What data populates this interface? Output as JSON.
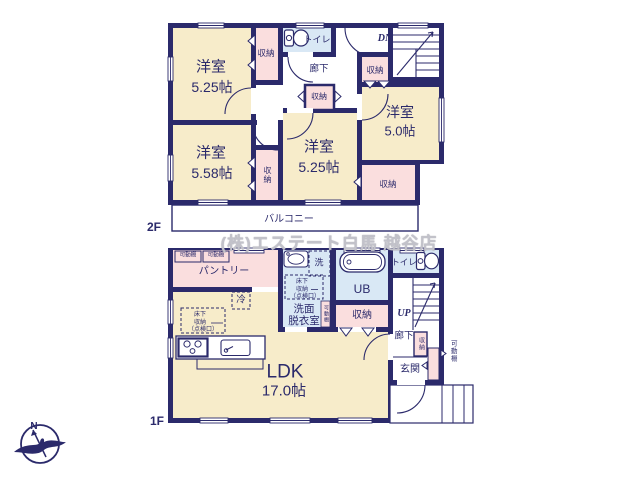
{
  "colors": {
    "wall": "#2b2a6b",
    "room_cream": "#f7ecca",
    "closet_pink": "#fadede",
    "wet_blue": "#d9e8f5",
    "watermark_gray": "#c2c2ca"
  },
  "watermark": "(株)エステート白馬 越谷店",
  "compass": {
    "north_label": "N"
  },
  "floor2": {
    "floor_label": "2F",
    "rooms": {
      "yoshitsu_a": {
        "name": "洋室",
        "size": "5.25帖"
      },
      "yoshitsu_b": {
        "name": "洋室",
        "size": "5.58帖"
      },
      "yoshitsu_c": {
        "name": "洋室",
        "size": "5.25帖"
      },
      "yoshitsu_d": {
        "name": "洋室",
        "size": "5.0帖"
      }
    },
    "closet_label": "収納",
    "toilet_label": "トイレ",
    "hallway_label": "廊下",
    "stairs_label": "DN",
    "balcony_label": "バルコニー"
  },
  "floor1": {
    "floor_label": "1F",
    "ldk": {
      "name": "LDK",
      "size": "17.0帖"
    },
    "pantry_label": "パントリー",
    "shelf_label": "可動棚",
    "fridge_label": "冷",
    "underfloor": {
      "line1": "床下",
      "line2": "収納",
      "line3": "（点検口）"
    },
    "washer_label": "洗",
    "washroom": {
      "line1": "洗面",
      "line2": "脱衣室"
    },
    "bath_label": "UB",
    "closet_label": "収納",
    "toilet_label": "トイレ",
    "stairs_label": "UP",
    "hallway_label": "廊下",
    "entrance_label": "玄関"
  }
}
